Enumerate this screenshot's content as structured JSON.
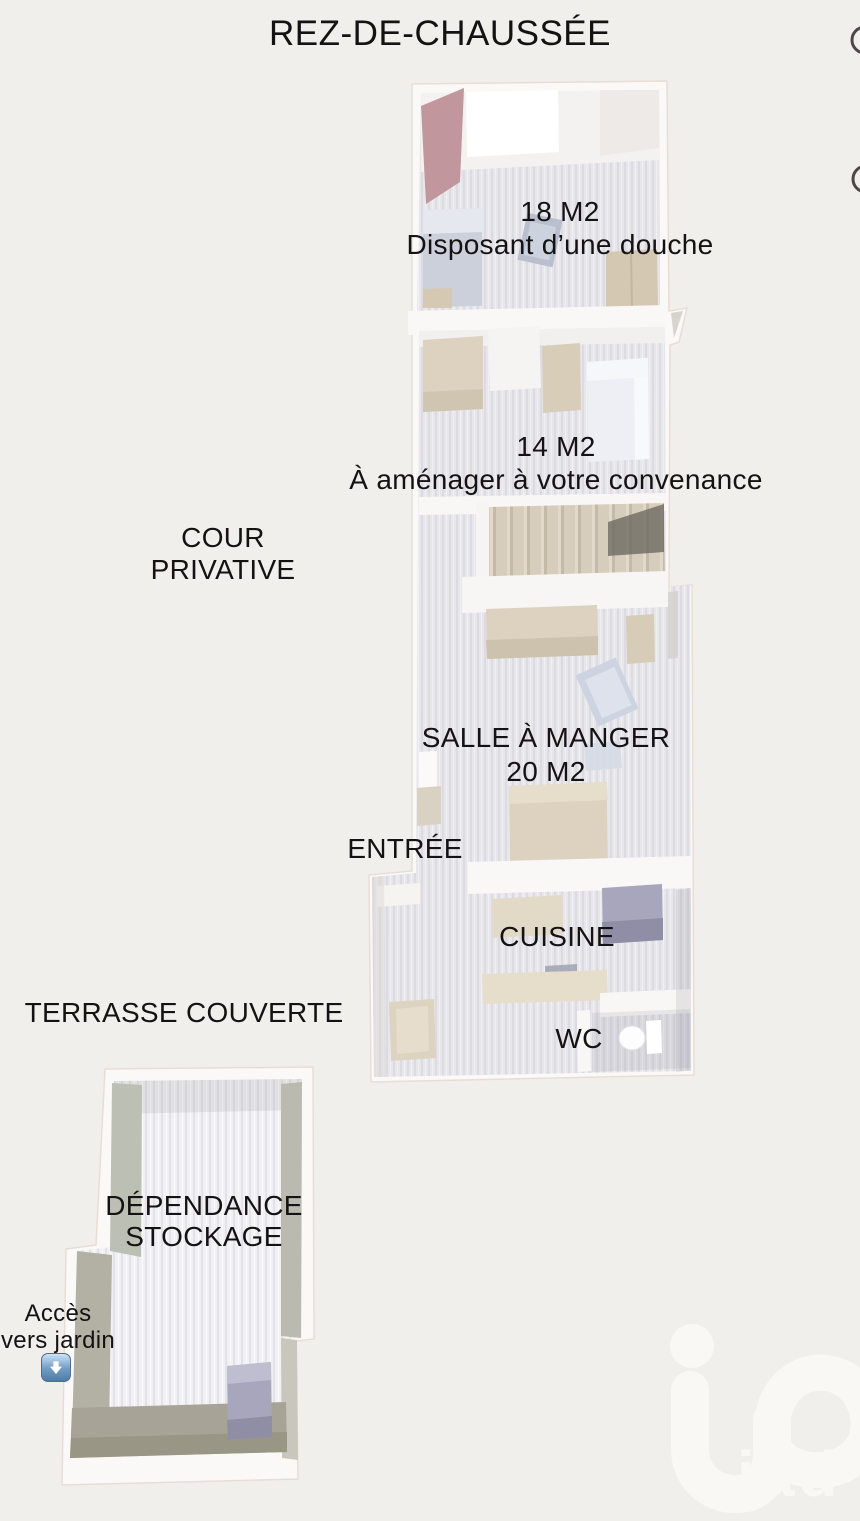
{
  "title": "REZ-DE-CHAUSSÉE",
  "labels": {
    "room18": {
      "area": "18 M2",
      "note": "Disposant d’une douche"
    },
    "room14": {
      "area": "14 M2",
      "note": "À aménager à votre convenance"
    },
    "cour": {
      "line1": "COUR",
      "line2": "PRIVATIVE"
    },
    "salle": {
      "line1": "SALLE À MANGER",
      "line2": "20 M2"
    },
    "entree": "ENTRÉE",
    "cuisine": "CUISINE",
    "terrasse": "TERRASSE COUVERTE",
    "wc": "WC",
    "dependance": {
      "line1": "DÉPENDANCE",
      "line2": "STOCKAGE"
    },
    "acces": {
      "line1": "Accès",
      "line2": "vers jardin"
    }
  },
  "watermark": {
    "brand": "iad"
  },
  "icons": {
    "garden_arrow": "down-arrow-icon"
  },
  "colors": {
    "bg": "#f1efec",
    "ink": "#141212",
    "wall-white": "#fbf9f7",
    "floor-light": "#e7e6ea",
    "accent-rose": "#c1969c",
    "wall-olive": "#bcbfb4",
    "furniture-beige": "#ddd2bf",
    "furniture-bluegray": "#ccd0db",
    "appliance-purple": "#a8a6bc",
    "arrow-blue": "#6f9cc4",
    "watermark": "#faf8f5"
  }
}
